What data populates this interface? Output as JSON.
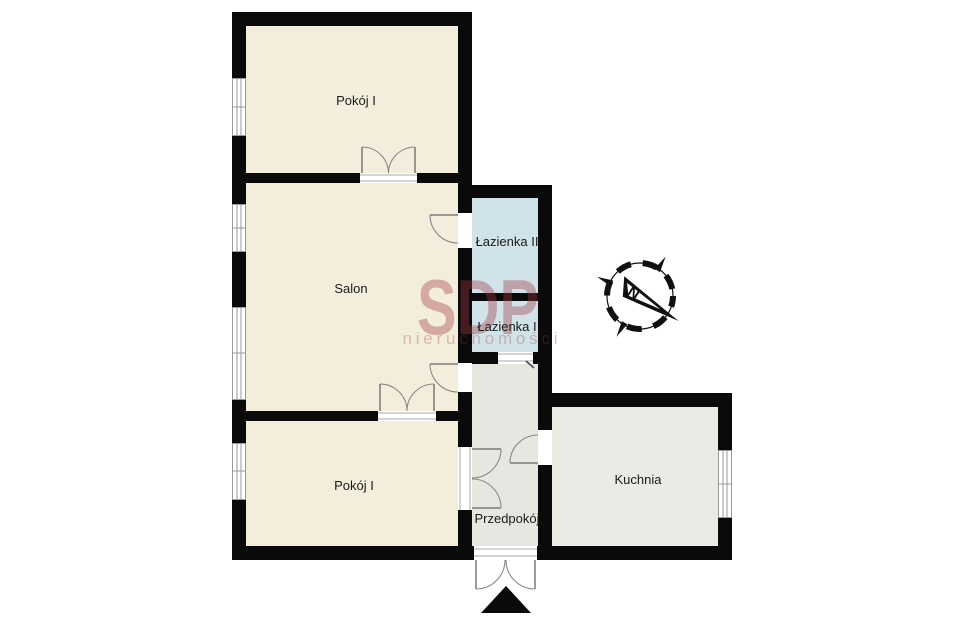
{
  "plan": {
    "rooms": {
      "pokoj_top": {
        "label": "Pokój I"
      },
      "salon": {
        "label": "Salon"
      },
      "pokoj_bottom": {
        "label": "Pokój I"
      },
      "lazienka_2": {
        "label": "Łazienka II"
      },
      "lazienka_1": {
        "label": "Łazienka I"
      },
      "przedpokoj": {
        "label": "Przedpokój"
      },
      "kuchnia": {
        "label": "Kuchnia"
      }
    },
    "compass": {
      "label": "N"
    },
    "watermark": {
      "brand": "SDP",
      "subtitle": "nieruchomości",
      "color": "#a43a46"
    },
    "colors": {
      "wall": "#0a0a0a",
      "room_fill": "#f3eedb",
      "bathroom_fill": "#cfe3e9",
      "hallway_fill": "#e8e6e1",
      "kitchen_fill": "#eceae4",
      "background": "#ffffff"
    }
  }
}
